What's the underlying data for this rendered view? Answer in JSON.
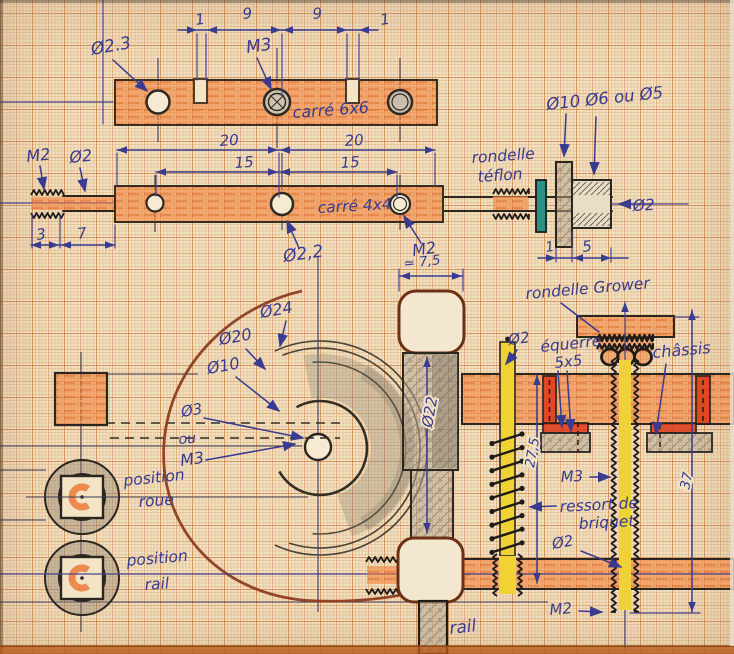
{
  "colors": {
    "ink": "#383b8f",
    "pencil": "#4a4337",
    "orange": "#e87430",
    "yellow": "#f0d234",
    "teal": "#2f8f85",
    "red": "#dd3d1c",
    "brown": "#8c3a1c",
    "paper": "#f2e2c4"
  },
  "top_view": {
    "dim_a": "1",
    "dim_b": "9",
    "dim_c": "9",
    "dim_d": "1",
    "hole": "Ø2.3",
    "thread": "M3",
    "part": "carré 6x6"
  },
  "front_view": {
    "dim_20a": "20",
    "dim_20b": "20",
    "dim_15a": "15",
    "dim_15b": "15",
    "thread_left": "M2",
    "dia_left": "Ø2",
    "dim_3": "3",
    "dim_7": "7",
    "part": "carré 4x4",
    "hole": "Ø2,2",
    "thread_right": "M2"
  },
  "pulley": {
    "dias": "Ø10 Ø6 ou Ø5",
    "washer_a": "rondelle",
    "washer_b": "téflon",
    "axle": "Ø2",
    "dim_flange": "1",
    "dim_body": "5"
  },
  "wheel": {
    "d24": "Ø24",
    "d20": "Ø20",
    "d10": "Ø10",
    "d3": "Ø3",
    "or_word": "ou",
    "m3": "M3",
    "width": "≃ 7,5",
    "d22": "Ø22"
  },
  "positions": {
    "wheel_a": "position",
    "wheel_b": "roue",
    "rail_a": "position",
    "rail_b": "rail"
  },
  "assembly": {
    "grower": "rondelle Grower",
    "rod_dia": "Ø2",
    "equerre": "équerre",
    "equerre_size": "5x5",
    "chassis": "châssis",
    "thread_m3": "M3",
    "spring_a": "ressort de",
    "spring_b": "briquet",
    "spring_dia": "Ø2",
    "thread_m2": "M2",
    "dim_height": "27,5",
    "dim_total": "37",
    "rail_label": "rail"
  }
}
